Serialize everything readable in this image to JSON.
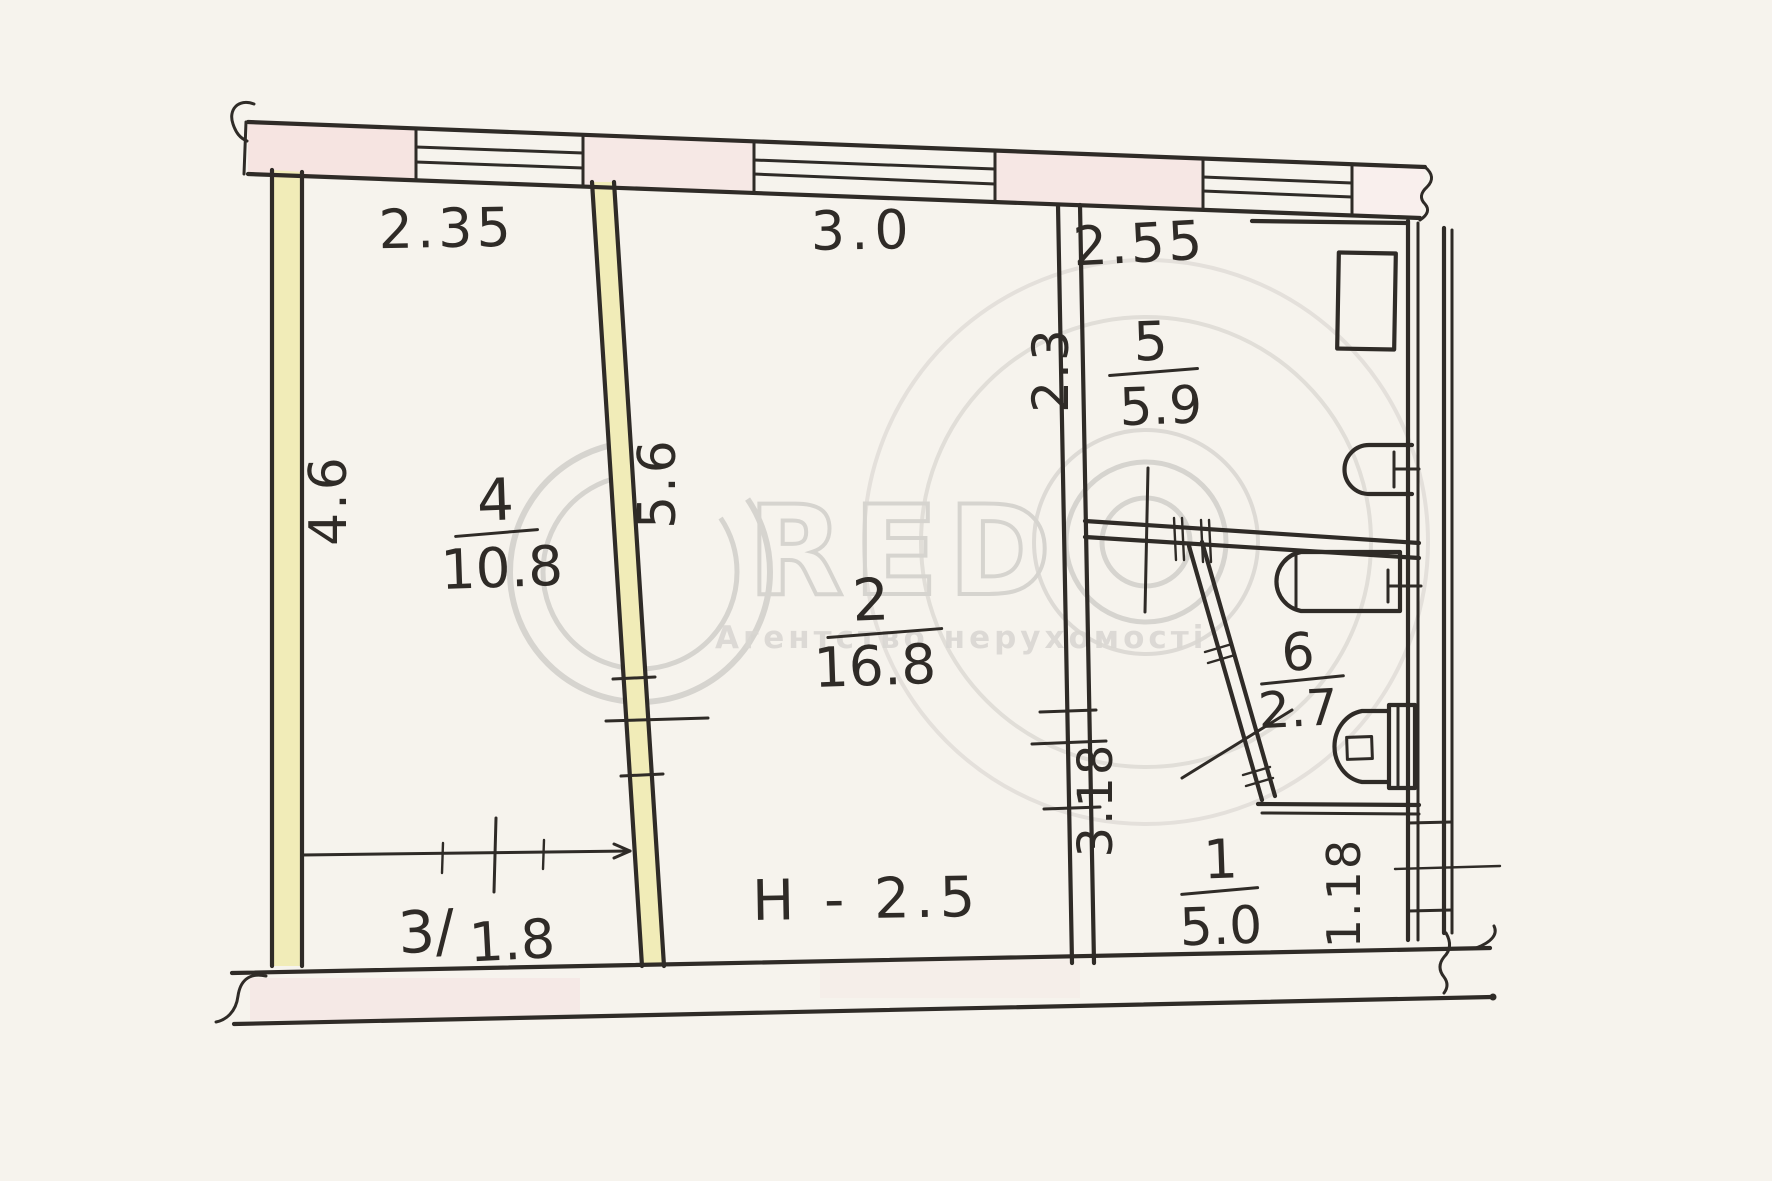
{
  "document": {
    "kind": "scanned hand-drawn apartment floor plan",
    "ceiling_height_label": "H - 2.5"
  },
  "rooms": [
    {
      "number": "4",
      "area": "10.8"
    },
    {
      "number": "2",
      "area": "16.8"
    },
    {
      "number": "5",
      "area": "5.9"
    },
    {
      "number": "6",
      "area": "2.7"
    },
    {
      "number": "1",
      "area": "5.0"
    },
    {
      "number_label": "3/",
      "area": "1.8"
    }
  ],
  "dimensions": {
    "room4_width": "2.35",
    "room2_width": "3.0",
    "room5_width": "2.55",
    "room4_depth": "4.6",
    "room2_depth": "5.6",
    "room5_depth": "2.3",
    "hall_depth": "3.18",
    "niche_width": "1.18"
  },
  "watermark": {
    "letter_c": "C",
    "letters_red": "RED",
    "letter_o_symbol": "concentric-circles-icon",
    "tagline": "Агентство нерухомості"
  },
  "colors": {
    "ink": "#2f2b27",
    "wall_yellow": "#f1ecb8",
    "pier_pink": "#f6e4e1",
    "paper": "#f6f3ed",
    "watermark_grey": "#c4c2be"
  }
}
